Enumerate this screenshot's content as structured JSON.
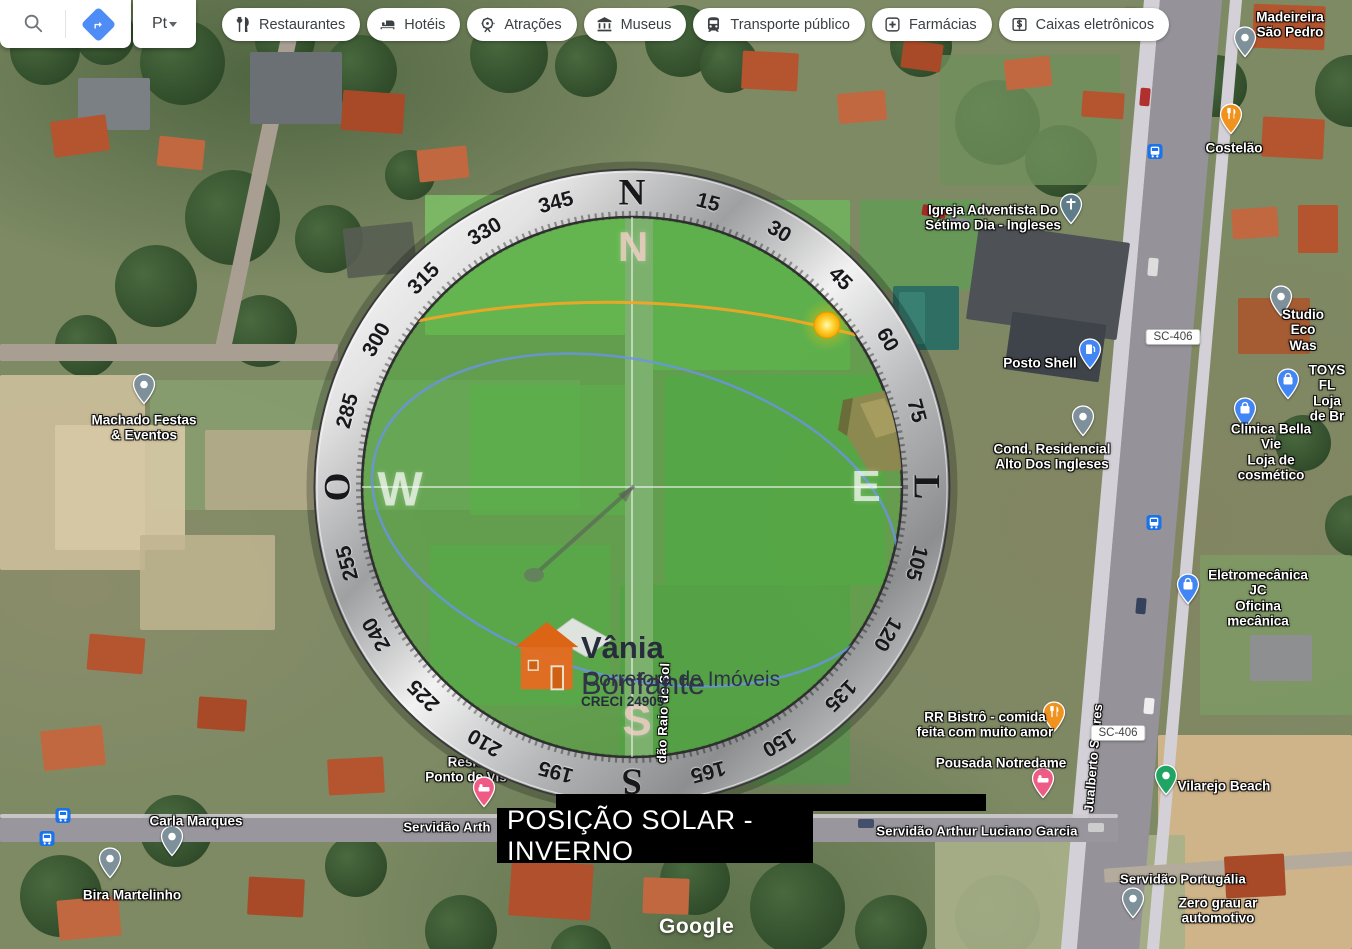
{
  "topbar": {
    "language_label": "Pt",
    "chips": [
      {
        "id": "restaurantes",
        "icon": "restaurants",
        "label": "Restaurantes"
      },
      {
        "id": "hoteis",
        "icon": "hotels",
        "label": "Hotéis"
      },
      {
        "id": "atracoes",
        "icon": "attractions",
        "label": "Atrações"
      },
      {
        "id": "museus",
        "icon": "museums",
        "label": "Museus"
      },
      {
        "id": "transporte-publico",
        "icon": "transit",
        "label": "Transporte público"
      },
      {
        "id": "farmacias",
        "icon": "pharmacies",
        "label": "Farmácias"
      },
      {
        "id": "caixas-eletronicos",
        "icon": "atms",
        "label": "Caixas eletrônicos"
      }
    ]
  },
  "compass": {
    "ring_labels": [
      {
        "angle": 0,
        "text": "N",
        "cardinal": true
      },
      {
        "angle": 15,
        "text": "15"
      },
      {
        "angle": 30,
        "text": "30"
      },
      {
        "angle": 45,
        "text": "45"
      },
      {
        "angle": 60,
        "text": "60"
      },
      {
        "angle": 75,
        "text": "75"
      },
      {
        "angle": 90,
        "text": "L",
        "cardinal": true
      },
      {
        "angle": 105,
        "text": "105"
      },
      {
        "angle": 120,
        "text": "120"
      },
      {
        "angle": 135,
        "text": "135"
      },
      {
        "angle": 150,
        "text": "150"
      },
      {
        "angle": 165,
        "text": "165"
      },
      {
        "angle": 180,
        "text": "S",
        "cardinal": true
      },
      {
        "angle": 195,
        "text": "195"
      },
      {
        "angle": 210,
        "text": "210"
      },
      {
        "angle": 225,
        "text": "225"
      },
      {
        "angle": 240,
        "text": "240"
      },
      {
        "angle": 255,
        "text": "255"
      },
      {
        "angle": 270,
        "text": "O",
        "cardinal": true
      },
      {
        "angle": 285,
        "text": "285"
      },
      {
        "angle": 300,
        "text": "300"
      },
      {
        "angle": 315,
        "text": "315"
      },
      {
        "angle": 330,
        "text": "330"
      },
      {
        "angle": 345,
        "text": "345"
      }
    ],
    "inner_letters": [
      {
        "text": "N",
        "x": 633,
        "y": 247,
        "color": "rgba(242,205,198,0.8)",
        "size": 42
      },
      {
        "text": "W",
        "x": 400,
        "y": 490,
        "color": "rgba(255,255,255,0.68)",
        "size": 48
      },
      {
        "text": "E",
        "x": 866,
        "y": 487,
        "color": "rgba(255,255,255,0.68)",
        "size": 44
      },
      {
        "text": "S",
        "x": 637,
        "y": 721,
        "color": "rgba(242,205,198,0.8)",
        "size": 44
      }
    ],
    "sun": {
      "x": 827,
      "y": 325,
      "color": "#FFC400"
    },
    "overlay_green": "#4AB23A",
    "sun_path_color": "#F5A623",
    "winter_path_color": "#6A93E8"
  },
  "solar_label": {
    "text": "POSIÇÃO SOLAR - INVERNO",
    "bg": "#000000",
    "fg": "#FFFFFF"
  },
  "watermark": {
    "name_bold": "Vânia",
    "name_regular": "Bonfante",
    "line2": "Corretora de Imóveis",
    "line3": "CRECI 24909"
  },
  "attribution": {
    "logo": "Google"
  },
  "map": {
    "shields": [
      {
        "text": "SC-406",
        "x": 1173,
        "y": 337
      },
      {
        "text": "SC-406",
        "x": 1118,
        "y": 733
      }
    ],
    "transit_stops": [
      {
        "x": 1155,
        "y": 154
      },
      {
        "x": 1154,
        "y": 525
      },
      {
        "x": 63,
        "y": 818
      },
      {
        "x": 47,
        "y": 841
      }
    ],
    "pois": [
      {
        "text": "Madeireira São Pedro",
        "x": 1290,
        "y": 25,
        "pin": {
          "type": "grey",
          "x": 1245,
          "y": 47
        }
      },
      {
        "text": "Costelão",
        "x": 1234,
        "y": 148,
        "pin": {
          "type": "restaurant",
          "x": 1231,
          "y": 124
        }
      },
      {
        "text": "Igreja Adventista Do\nSétimo Dia - Ingleses",
        "x": 993,
        "y": 218,
        "pin": {
          "type": "church",
          "x": 1071,
          "y": 214
        }
      },
      {
        "text": "Posto Shell",
        "x": 1040,
        "y": 363,
        "pin": {
          "type": "fuel",
          "x": 1090,
          "y": 359
        }
      },
      {
        "text": "Cond. Residencial\nAlto Dos Ingleses",
        "x": 1052,
        "y": 457,
        "pin": {
          "type": "grey",
          "x": 1083,
          "y": 426
        }
      },
      {
        "text": "Studio Eco Was",
        "x": 1303,
        "y": 330,
        "pin": {
          "type": "grey",
          "x": 1281,
          "y": 306
        }
      },
      {
        "text": "TOYS FL\nLoja de Br",
        "x": 1327,
        "y": 393,
        "pin": {
          "type": "shopping",
          "x": 1288,
          "y": 389
        }
      },
      {
        "text": "Clinica Bella Vie\nLoja de cosmético",
        "x": 1271,
        "y": 452,
        "pin": {
          "type": "shopping",
          "x": 1245,
          "y": 418
        }
      },
      {
        "text": "Machado Festas\n& Eventos",
        "x": 144,
        "y": 428,
        "pin": {
          "type": "grey",
          "x": 144,
          "y": 394
        }
      },
      {
        "text": "Eletromecânica JC\nOficina mecânica",
        "x": 1258,
        "y": 598,
        "pin": {
          "type": "shopping",
          "x": 1188,
          "y": 594
        }
      },
      {
        "text": "RR Bistrô - comida\nfeita com muito amor",
        "x": 985,
        "y": 725,
        "pin": {
          "type": "restaurant",
          "x": 1054,
          "y": 722
        }
      },
      {
        "text": "Pousada Notredame",
        "x": 1001,
        "y": 763,
        "pin": {
          "type": "lodging",
          "x": 1043,
          "y": 788
        }
      },
      {
        "text": "Vilarejo Beach",
        "x": 1224,
        "y": 786,
        "pin": {
          "type": "green",
          "x": 1166,
          "y": 785
        }
      },
      {
        "text": "Zero grau ar automotivo",
        "x": 1218,
        "y": 911,
        "pin": {
          "type": "grey",
          "x": 1133,
          "y": 908
        }
      },
      {
        "text": "Carla Marques",
        "x": 196,
        "y": 821,
        "pin": {
          "type": "grey",
          "x": 172,
          "y": 846
        }
      },
      {
        "text": "Bira Martelinho",
        "x": 132,
        "y": 895,
        "pin": {
          "type": "grey",
          "x": 110,
          "y": 868
        }
      },
      {
        "text": "Resid\nPonto de Vis",
        "x": 466,
        "y": 770,
        "under": true,
        "pin": {
          "type": "lodging",
          "x": 484,
          "y": 797
        }
      },
      {
        "text": "ar · $$",
        "x": 1120,
        "y": 15,
        "fs": 12
      }
    ],
    "streets": [
      {
        "text": "Servidão Arth",
        "x": 447,
        "y": 828
      },
      {
        "text": "Servidão Arthur Luciano Garcia",
        "x": 977,
        "y": 832
      },
      {
        "text": "Servidão Portugália",
        "x": 1183,
        "y": 880
      },
      {
        "text": "Jualberto Soares",
        "x": 1094,
        "y": 758,
        "rot": -85
      },
      {
        "text": "dão Raio de Sol",
        "x": 664,
        "y": 713,
        "rot": -88
      }
    ]
  }
}
